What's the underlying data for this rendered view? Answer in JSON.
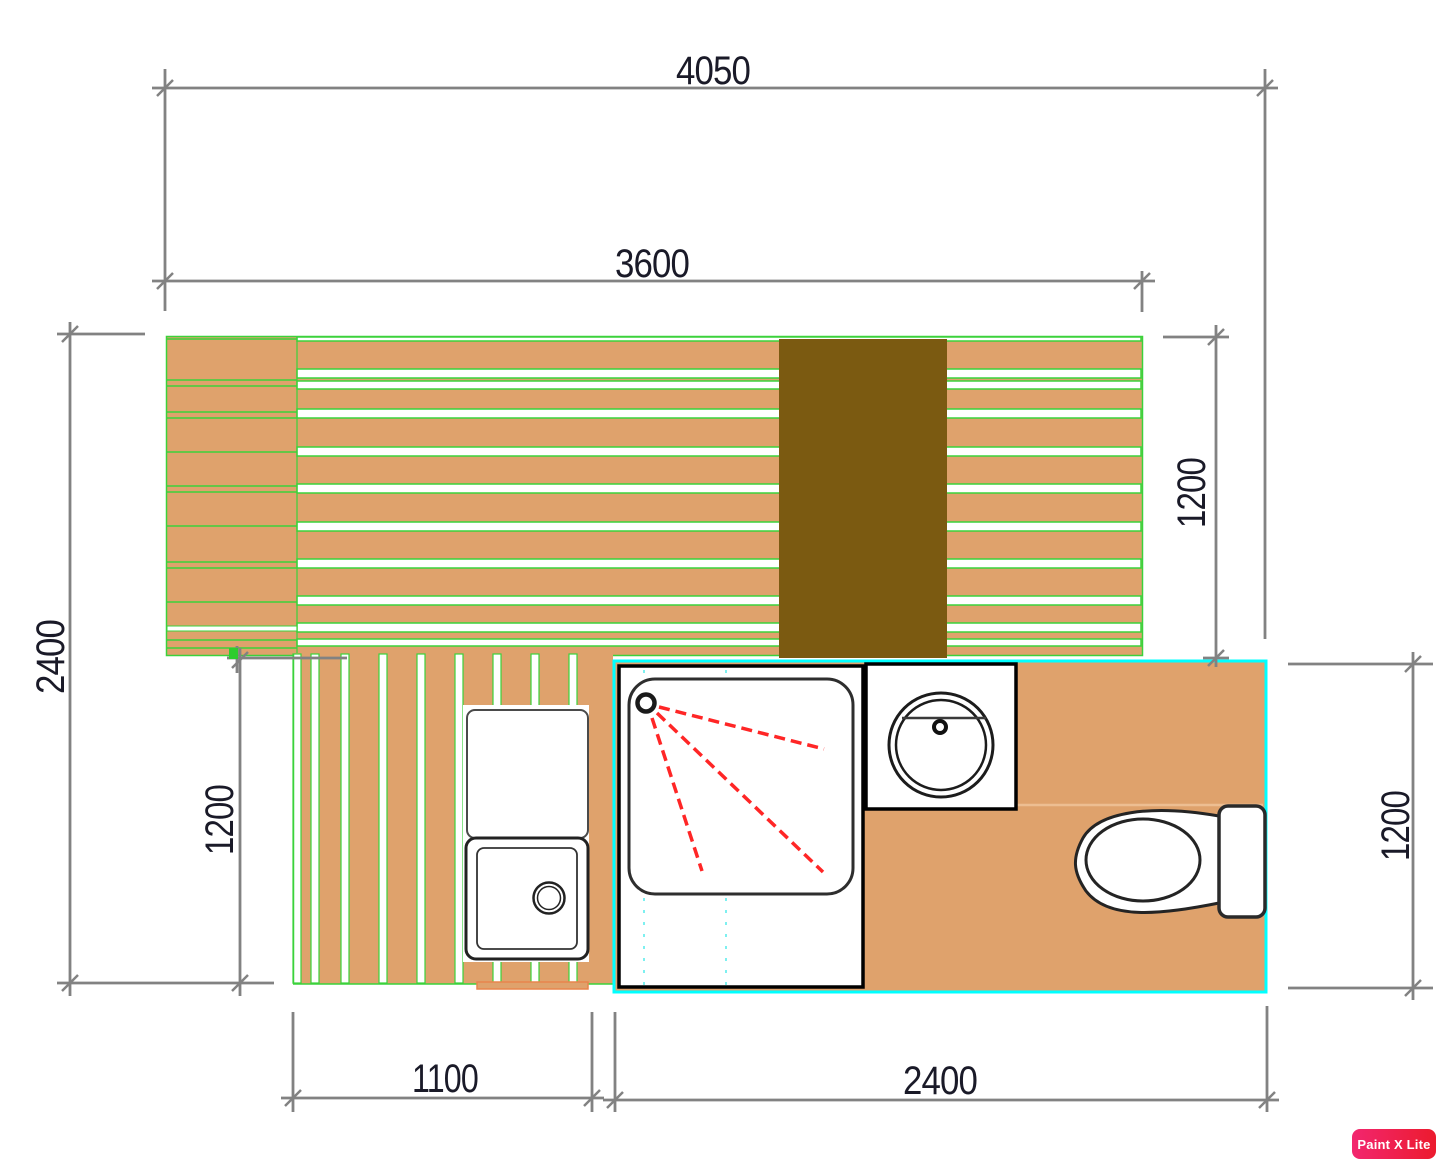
{
  "title": "Deck and bathroom floor plan",
  "dimensions": {
    "overall_width": "4050",
    "deck_width": "3600",
    "overall_depth": "2400",
    "upper_deck_depth": "1200",
    "lower_deck_depth": "1200",
    "bathroom_depth": "1200",
    "lower_deck_width": "1100",
    "bathroom_width": "2400"
  },
  "fixtures": {
    "walkway": "walkway",
    "shower": "shower",
    "washbasin": "washbasin",
    "toilet": "toilet",
    "sink_counter": "sink-counter"
  },
  "colors": {
    "deck_tan": "#DFA26C",
    "plank_line_green": "#3BD23B",
    "walkway_brown": "#7B5A11",
    "bathroom_border_cyan": "#00FFFF",
    "fixture_outline": "#222222",
    "spray_red": "#FF2626",
    "dimension_gray": "#828282",
    "dimension_text": "#1A1A28",
    "floor_seam": "#EDBE92",
    "badge_pink": "#F2266F",
    "badge_red": "#EC1B2E"
  },
  "watermark": {
    "label": "Paint X Lite"
  }
}
